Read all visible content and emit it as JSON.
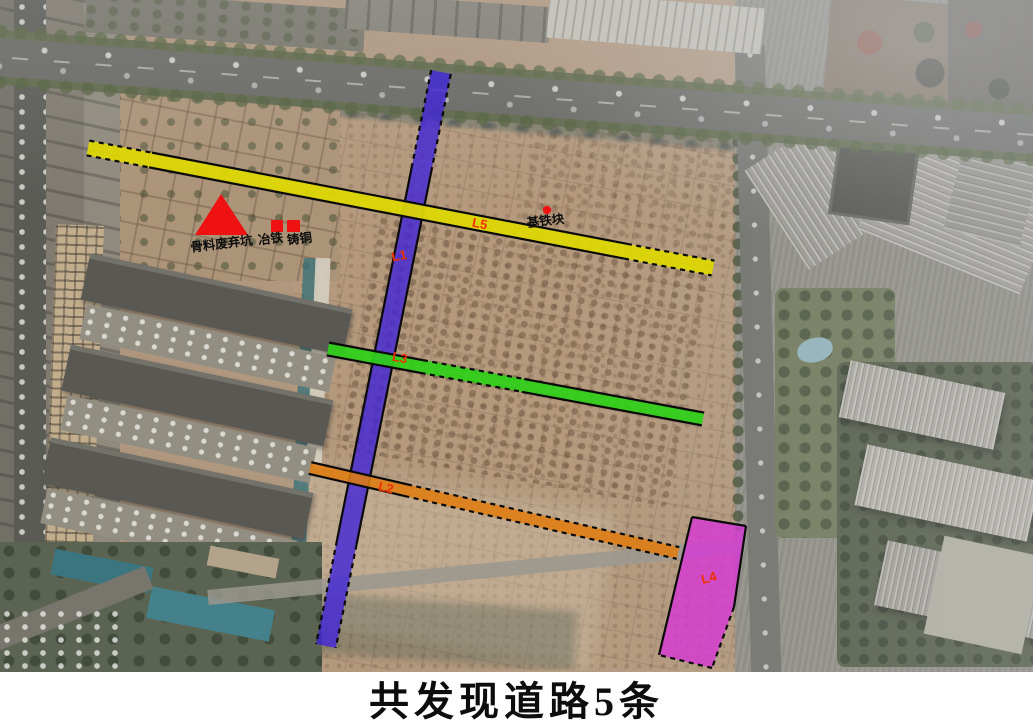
{
  "caption": "共发现道路5条",
  "map": {
    "label_color": "#f23000",
    "marker_color": "#ee1212",
    "marker_text_color": "#0d0d0d",
    "roads": [
      {
        "id": "L1",
        "label": "L1",
        "color": "#4226d8",
        "opacity": 0.8,
        "width": 20,
        "x1": 441,
        "y1": 72,
        "x2": 326,
        "y2": 646,
        "lx": 400,
        "ly": 260,
        "lr": -10,
        "border": [
          {
            "f": 0,
            "t": 0.17,
            "dash": true
          },
          {
            "f": 0.17,
            "t": 0.82,
            "dash": false
          },
          {
            "f": 0.82,
            "t": 1,
            "dash": true
          }
        ]
      },
      {
        "id": "L5",
        "label": "L5",
        "color": "#e0d903",
        "opacity": 0.93,
        "width": 15,
        "x1": 88,
        "y1": 148,
        "x2": 713,
        "y2": 268,
        "lx": 479,
        "ly": 228,
        "lr": 11,
        "border": [
          {
            "f": 0,
            "t": 0.1,
            "dash": true
          },
          {
            "f": 0.1,
            "t": 0.86,
            "dash": false
          },
          {
            "f": 0.86,
            "t": 1,
            "dash": true
          }
        ]
      },
      {
        "id": "L3",
        "label": "L3",
        "color": "#2fd119",
        "opacity": 0.93,
        "width": 13,
        "x1": 328,
        "y1": 349,
        "x2": 703,
        "y2": 419,
        "lx": 399,
        "ly": 362,
        "lr": 11,
        "border": [
          {
            "f": 0,
            "t": 0.25,
            "dash": false
          },
          {
            "f": 0.25,
            "t": 0.52,
            "dash": true
          },
          {
            "f": 0.52,
            "t": 1,
            "dash": false
          }
        ]
      },
      {
        "id": "L2",
        "label": "L2",
        "color": "#e07d12",
        "opacity": 0.88,
        "width": 12,
        "x1": 310,
        "y1": 468,
        "x2": 678,
        "y2": 553,
        "lx": 385,
        "ly": 492,
        "lr": 13,
        "border": [
          {
            "f": 0,
            "t": 0.26,
            "dash": false
          },
          {
            "f": 0.26,
            "t": 1,
            "dash": true
          }
        ]
      }
    ],
    "area_road": {
      "id": "L4",
      "label": "L4",
      "color": "#d935d9",
      "opacity": 0.78,
      "points": [
        [
          692,
          517
        ],
        [
          746,
          526
        ],
        [
          734,
          607
        ],
        [
          712,
          668
        ],
        [
          659,
          655
        ]
      ],
      "edges": [
        {
          "a": 0,
          "b": 1,
          "dash": false
        },
        {
          "a": 1,
          "b": 2,
          "dash": false
        },
        {
          "a": 2,
          "b": 3,
          "dash": true
        },
        {
          "a": 3,
          "b": 4,
          "dash": true
        },
        {
          "a": 4,
          "b": 0,
          "dash": false
        }
      ],
      "lx": 710,
      "ly": 582,
      "lr": -15
    },
    "markers": {
      "triangle": {
        "points": [
          [
            221,
            194
          ],
          [
            195,
            235
          ],
          [
            248,
            235
          ]
        ],
        "label": "骨料废弃坑",
        "lx": 222,
        "ly": 248,
        "lr": -7
      },
      "squares": [
        {
          "x": 271,
          "y": 220,
          "w": 12,
          "h": 12,
          "label": "冶铁",
          "lx": 271,
          "ly": 243,
          "lr": -7
        },
        {
          "x": 287,
          "y": 220,
          "w": 13,
          "h": 12,
          "label": "铸铜",
          "lx": 300,
          "ly": 243,
          "lr": -7
        }
      ],
      "dot": {
        "cx": 547,
        "cy": 210,
        "r": 4.2,
        "label": "基铁块",
        "lx": 546,
        "ly": 225,
        "lr": -7
      }
    }
  }
}
